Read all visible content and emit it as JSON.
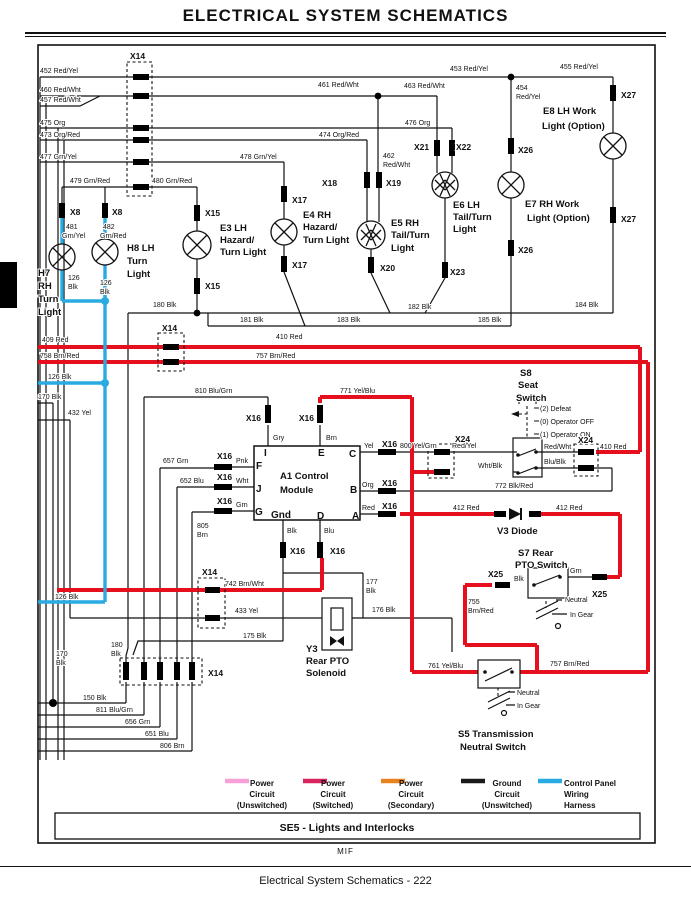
{
  "title": "ELECTRICAL   SYSTEM SCHEMATICS",
  "footer": {
    "mif": "MIF",
    "caption": "Electrical   System Schematics  - 222"
  },
  "colors": {
    "power_switched_wire": "#e60f1e",
    "control_panel_wire": "#29abe2",
    "ground_wire": "#111111",
    "legend_unswitched": "#f7a0d8",
    "legend_switched": "#d8235f",
    "legend_secondary": "#e8821e",
    "legend_ground": "#1a1a1a",
    "legend_harness": "#29abe2"
  },
  "legend": [
    {
      "x": 225,
      "color": "#f7a0d8",
      "cx": 262,
      "anchor": "middle",
      "lines": [
        "Power",
        "Circuit",
        "(Unswitched)"
      ]
    },
    {
      "x": 303,
      "color": "#d8235f",
      "cx": 333,
      "anchor": "middle",
      "lines": [
        "Power",
        "Circuit",
        "(Switched)"
      ]
    },
    {
      "x": 381,
      "color": "#e8821e",
      "cx": 411,
      "anchor": "middle",
      "lines": [
        "Power",
        "Circuit",
        "(Secondary)"
      ]
    },
    {
      "x": 461,
      "color": "#1a1a1a",
      "cx": 507,
      "anchor": "middle",
      "lines": [
        "Ground",
        "Circuit",
        "(Unswitched)"
      ]
    },
    {
      "x": 538,
      "color": "#29abe2",
      "cx": 564,
      "anchor": "start",
      "lines": [
        "Control Panel",
        "Wiring",
        "Harness"
      ]
    }
  ],
  "schematic": {
    "labels": [
      [
        "452 Red/Yel",
        40,
        73,
        "w"
      ],
      [
        "460 Red/Wht",
        40,
        92,
        "w"
      ],
      [
        "457 Red/Wht",
        40,
        102,
        "w"
      ],
      [
        "475 Org",
        40,
        125,
        "w"
      ],
      [
        "473 Org/Red",
        40,
        137,
        "w"
      ],
      [
        "477 Grn/Yel",
        40,
        159,
        "w"
      ],
      [
        "479 Grn/Red",
        70,
        183,
        "w"
      ],
      [
        "480 Grn/Red",
        152,
        183,
        "w"
      ],
      [
        "461 Red/Wht",
        318,
        87,
        "w"
      ],
      [
        "463 Red/Wht",
        404,
        88,
        "w"
      ],
      [
        "453 Red/Yel",
        450,
        71,
        "w"
      ],
      [
        "455 Red/Yel",
        560,
        69,
        "w"
      ],
      [
        "454",
        516,
        90,
        "w"
      ],
      [
        "Red/Yel",
        516,
        99,
        "w"
      ],
      [
        "476 Org",
        405,
        125,
        "w"
      ],
      [
        "474 Org/Red",
        319,
        137,
        "w"
      ],
      [
        "478 Grn/Yel",
        240,
        159,
        "w"
      ],
      [
        "462",
        383,
        158,
        "w"
      ],
      [
        "Red/Wht",
        383,
        167,
        "w"
      ],
      [
        "481",
        66,
        229,
        "w"
      ],
      [
        "Grn/Yel",
        62,
        238,
        "w"
      ],
      [
        "482",
        103,
        229,
        "w"
      ],
      [
        "Grn/Red",
        100,
        238,
        "w"
      ],
      [
        "126",
        68,
        280,
        "w"
      ],
      [
        "Blk",
        68,
        289,
        "w"
      ],
      [
        "126",
        100,
        285,
        "w"
      ],
      [
        "Blk",
        100,
        294,
        "w"
      ],
      [
        "180 Blk",
        153,
        307,
        "w"
      ],
      [
        "181 Blk",
        240,
        322,
        "w"
      ],
      [
        "183 Blk",
        337,
        322,
        "w"
      ],
      [
        "182 Blk",
        408,
        309,
        "w"
      ],
      [
        "185 Blk",
        478,
        322,
        "w"
      ],
      [
        "184 Blk",
        575,
        307,
        "w"
      ],
      [
        "409 Red",
        42,
        342,
        "w"
      ],
      [
        "758 Brn/Red",
        40,
        358,
        "w"
      ],
      [
        "410 Red",
        276,
        339,
        "w"
      ],
      [
        "757 Brn/Red",
        256,
        358,
        "w"
      ],
      [
        "126 Blk",
        48,
        379,
        "w"
      ],
      [
        "170 Blk",
        38,
        399,
        "w"
      ],
      [
        "432 Yel",
        68,
        415,
        "w"
      ],
      [
        "810 Blu/Grn",
        195,
        393,
        "w"
      ],
      [
        "771 Yel/Blu",
        340,
        393,
        "w"
      ],
      [
        "657 Grn",
        163,
        463,
        "w"
      ],
      [
        "652 Blu",
        180,
        483,
        "w"
      ],
      [
        "805",
        197,
        528,
        "w"
      ],
      [
        "Brn",
        197,
        537,
        "w"
      ],
      [
        "Gry",
        273,
        440,
        "w"
      ],
      [
        "Brn",
        326,
        440,
        "w"
      ],
      [
        "Yel",
        364,
        448,
        "w"
      ],
      [
        "Org",
        362,
        487,
        "w"
      ],
      [
        "Red",
        362,
        510,
        "w"
      ],
      [
        "Blk",
        287,
        533,
        "w"
      ],
      [
        "Blu",
        324,
        533,
        "w"
      ],
      [
        "Pnk",
        236,
        463,
        "w"
      ],
      [
        "Wht",
        236,
        483,
        "w"
      ],
      [
        "Grn",
        236,
        507,
        "w"
      ],
      [
        "800 Yel/Grn",
        400,
        448,
        "w"
      ],
      [
        "Red/Yel",
        452,
        448,
        "w"
      ],
      [
        "Wht/Blk",
        478,
        468,
        "w"
      ],
      [
        "Red/Wht",
        544,
        449,
        "w"
      ],
      [
        "Blu/Blk",
        544,
        464,
        "w"
      ],
      [
        "772 Blk/Red",
        495,
        488,
        "w"
      ],
      [
        "410 Red",
        600,
        449,
        "w"
      ],
      [
        "412 Red",
        453,
        510,
        "w"
      ],
      [
        "412 Red",
        556,
        510,
        "w"
      ],
      [
        "Grn",
        570,
        573,
        "w"
      ],
      [
        "Blk",
        514,
        581,
        "w"
      ],
      [
        "755",
        468,
        604,
        "w"
      ],
      [
        "Brn/Red",
        468,
        613,
        "w"
      ],
      [
        "761 Yel/Blu",
        428,
        668,
        "w"
      ],
      [
        "757 Brn/Red",
        550,
        666,
        "w"
      ],
      [
        "742 Brn/Wht",
        225,
        586,
        "w"
      ],
      [
        "433 Yel",
        235,
        613,
        "w"
      ],
      [
        "177",
        366,
        584,
        "w"
      ],
      [
        "Blk",
        366,
        593,
        "w"
      ],
      [
        "176 Blk",
        372,
        612,
        "w"
      ],
      [
        "175 Blk",
        243,
        638,
        "w"
      ],
      [
        "180",
        111,
        647,
        "w"
      ],
      [
        "Blk",
        111,
        656,
        "w"
      ],
      [
        "170",
        56,
        656,
        "w"
      ],
      [
        "Blk",
        56,
        665,
        "w"
      ],
      [
        "126 Blk",
        55,
        599,
        "w"
      ],
      [
        "150 Blk",
        83,
        700,
        "w"
      ],
      [
        "811 Blu/Grn",
        96,
        712,
        "w"
      ],
      [
        "656 Grn",
        125,
        724,
        "w"
      ],
      [
        "651 Blu",
        145,
        736,
        "w"
      ],
      [
        "806 Brn",
        160,
        748,
        "w"
      ],
      [
        "(2) Defeat",
        540,
        411,
        "w"
      ],
      [
        "(0) Operator OFF",
        540,
        424,
        "w"
      ],
      [
        "(1) Operator ON",
        540,
        437,
        "w"
      ],
      [
        "Neutral",
        565,
        602,
        "w"
      ],
      [
        "In Gear",
        570,
        617,
        "w"
      ],
      [
        "Neutral",
        517,
        695,
        "w"
      ],
      [
        "In Gear",
        517,
        708,
        "w"
      ],
      [
        "X14",
        130,
        59,
        "c"
      ],
      [
        "X8",
        70,
        215,
        "c"
      ],
      [
        "X8",
        112,
        215,
        "c"
      ],
      [
        "X15",
        205,
        216,
        "c"
      ],
      [
        "X15",
        205,
        289,
        "c"
      ],
      [
        "X17",
        292,
        203,
        "c"
      ],
      [
        "X17",
        292,
        268,
        "c"
      ],
      [
        "X18",
        322,
        186,
        "c"
      ],
      [
        "X19",
        386,
        186,
        "c"
      ],
      [
        "X20",
        380,
        271,
        "c"
      ],
      [
        "X21",
        414,
        150,
        "c"
      ],
      [
        "X22",
        456,
        150,
        "c"
      ],
      [
        "X23",
        450,
        275,
        "c"
      ],
      [
        "X26",
        518,
        153,
        "c"
      ],
      [
        "X26",
        518,
        253,
        "c"
      ],
      [
        "X27",
        621,
        98,
        "c"
      ],
      [
        "X27",
        621,
        222,
        "c"
      ],
      [
        "X14",
        162,
        331,
        "c"
      ],
      [
        "X16",
        261,
        421,
        "c",
        "end"
      ],
      [
        "X16",
        314,
        421,
        "c",
        "end"
      ],
      [
        "X16",
        382,
        447,
        "c"
      ],
      [
        "X16",
        382,
        486,
        "c"
      ],
      [
        "X16",
        382,
        509,
        "c"
      ],
      [
        "X16",
        217,
        459,
        "c"
      ],
      [
        "X16",
        217,
        480,
        "c"
      ],
      [
        "X16",
        217,
        504,
        "c"
      ],
      [
        "X16",
        290,
        554,
        "c"
      ],
      [
        "X16",
        330,
        554,
        "c"
      ],
      [
        "X24",
        455,
        442,
        "c"
      ],
      [
        "X24",
        578,
        443,
        "c"
      ],
      [
        "X25",
        488,
        577,
        "c"
      ],
      [
        "X25",
        592,
        597,
        "c"
      ],
      [
        "X14",
        202,
        575,
        "c"
      ],
      [
        "X14",
        208,
        676,
        "c"
      ],
      [
        "H7",
        38,
        276,
        "t"
      ],
      [
        "RH",
        38,
        289,
        "t"
      ],
      [
        "Turn",
        38,
        302,
        "t"
      ],
      [
        "Light",
        38,
        315,
        "t"
      ],
      [
        "H8 LH",
        127,
        251,
        "t"
      ],
      [
        "Turn",
        127,
        264,
        "t"
      ],
      [
        "Light",
        127,
        277,
        "t"
      ],
      [
        "E3 LH",
        220,
        231,
        "t"
      ],
      [
        "Hazard/",
        220,
        243,
        "t"
      ],
      [
        "Turn Light",
        220,
        255,
        "t"
      ],
      [
        "E4 RH",
        303,
        218,
        "t"
      ],
      [
        "Hazard/",
        303,
        230,
        "t"
      ],
      [
        "Turn Light",
        303,
        243,
        "t"
      ],
      [
        "E5 RH",
        391,
        226,
        "t"
      ],
      [
        "Tail/Turn",
        391,
        238,
        "t"
      ],
      [
        "Light",
        391,
        251,
        "t"
      ],
      [
        "E6 LH",
        453,
        208,
        "t"
      ],
      [
        "Tail/Turn",
        453,
        220,
        "t"
      ],
      [
        "Light",
        453,
        232,
        "t"
      ],
      [
        "E7 RH Work",
        525,
        207,
        "t"
      ],
      [
        "Light (Option)",
        527,
        221,
        "t"
      ],
      [
        "E8 LH Work",
        543,
        114,
        "t"
      ],
      [
        "Light (Option)",
        542,
        129,
        "t"
      ],
      [
        "A1 Control",
        280,
        479,
        "t"
      ],
      [
        "Module",
        280,
        493,
        "t"
      ],
      [
        "S8",
        520,
        376,
        "t"
      ],
      [
        "Seat",
        518,
        388,
        "t"
      ],
      [
        "Switch",
        516,
        401,
        "t"
      ],
      [
        "V3 Diode",
        497,
        534,
        "t"
      ],
      [
        "S7 Rear",
        518,
        556,
        "t"
      ],
      [
        "PTO Switch",
        515,
        568,
        "t"
      ],
      [
        "Y3",
        306,
        652,
        "t"
      ],
      [
        "Rear PTO",
        306,
        664,
        "t"
      ],
      [
        "Solenoid",
        306,
        676,
        "t"
      ],
      [
        "S5 Transmission",
        458,
        737,
        "t"
      ],
      [
        "Neutral Switch",
        460,
        750,
        "t"
      ],
      [
        "I",
        264,
        456,
        "p"
      ],
      [
        "E",
        318,
        456,
        "p"
      ],
      [
        "C",
        349,
        457,
        "p"
      ],
      [
        "F",
        256,
        469,
        "p"
      ],
      [
        "J",
        256,
        492,
        "p"
      ],
      [
        "G",
        255,
        515,
        "p"
      ],
      [
        "B",
        350,
        493,
        "p"
      ],
      [
        "A",
        352,
        519,
        "p"
      ],
      [
        "D",
        317,
        519,
        "p"
      ],
      [
        "Gnd",
        271,
        518,
        "p"
      ],
      [
        "SE5 - Lights and Interlocks",
        347,
        831,
        "s",
        "middle"
      ]
    ]
  }
}
